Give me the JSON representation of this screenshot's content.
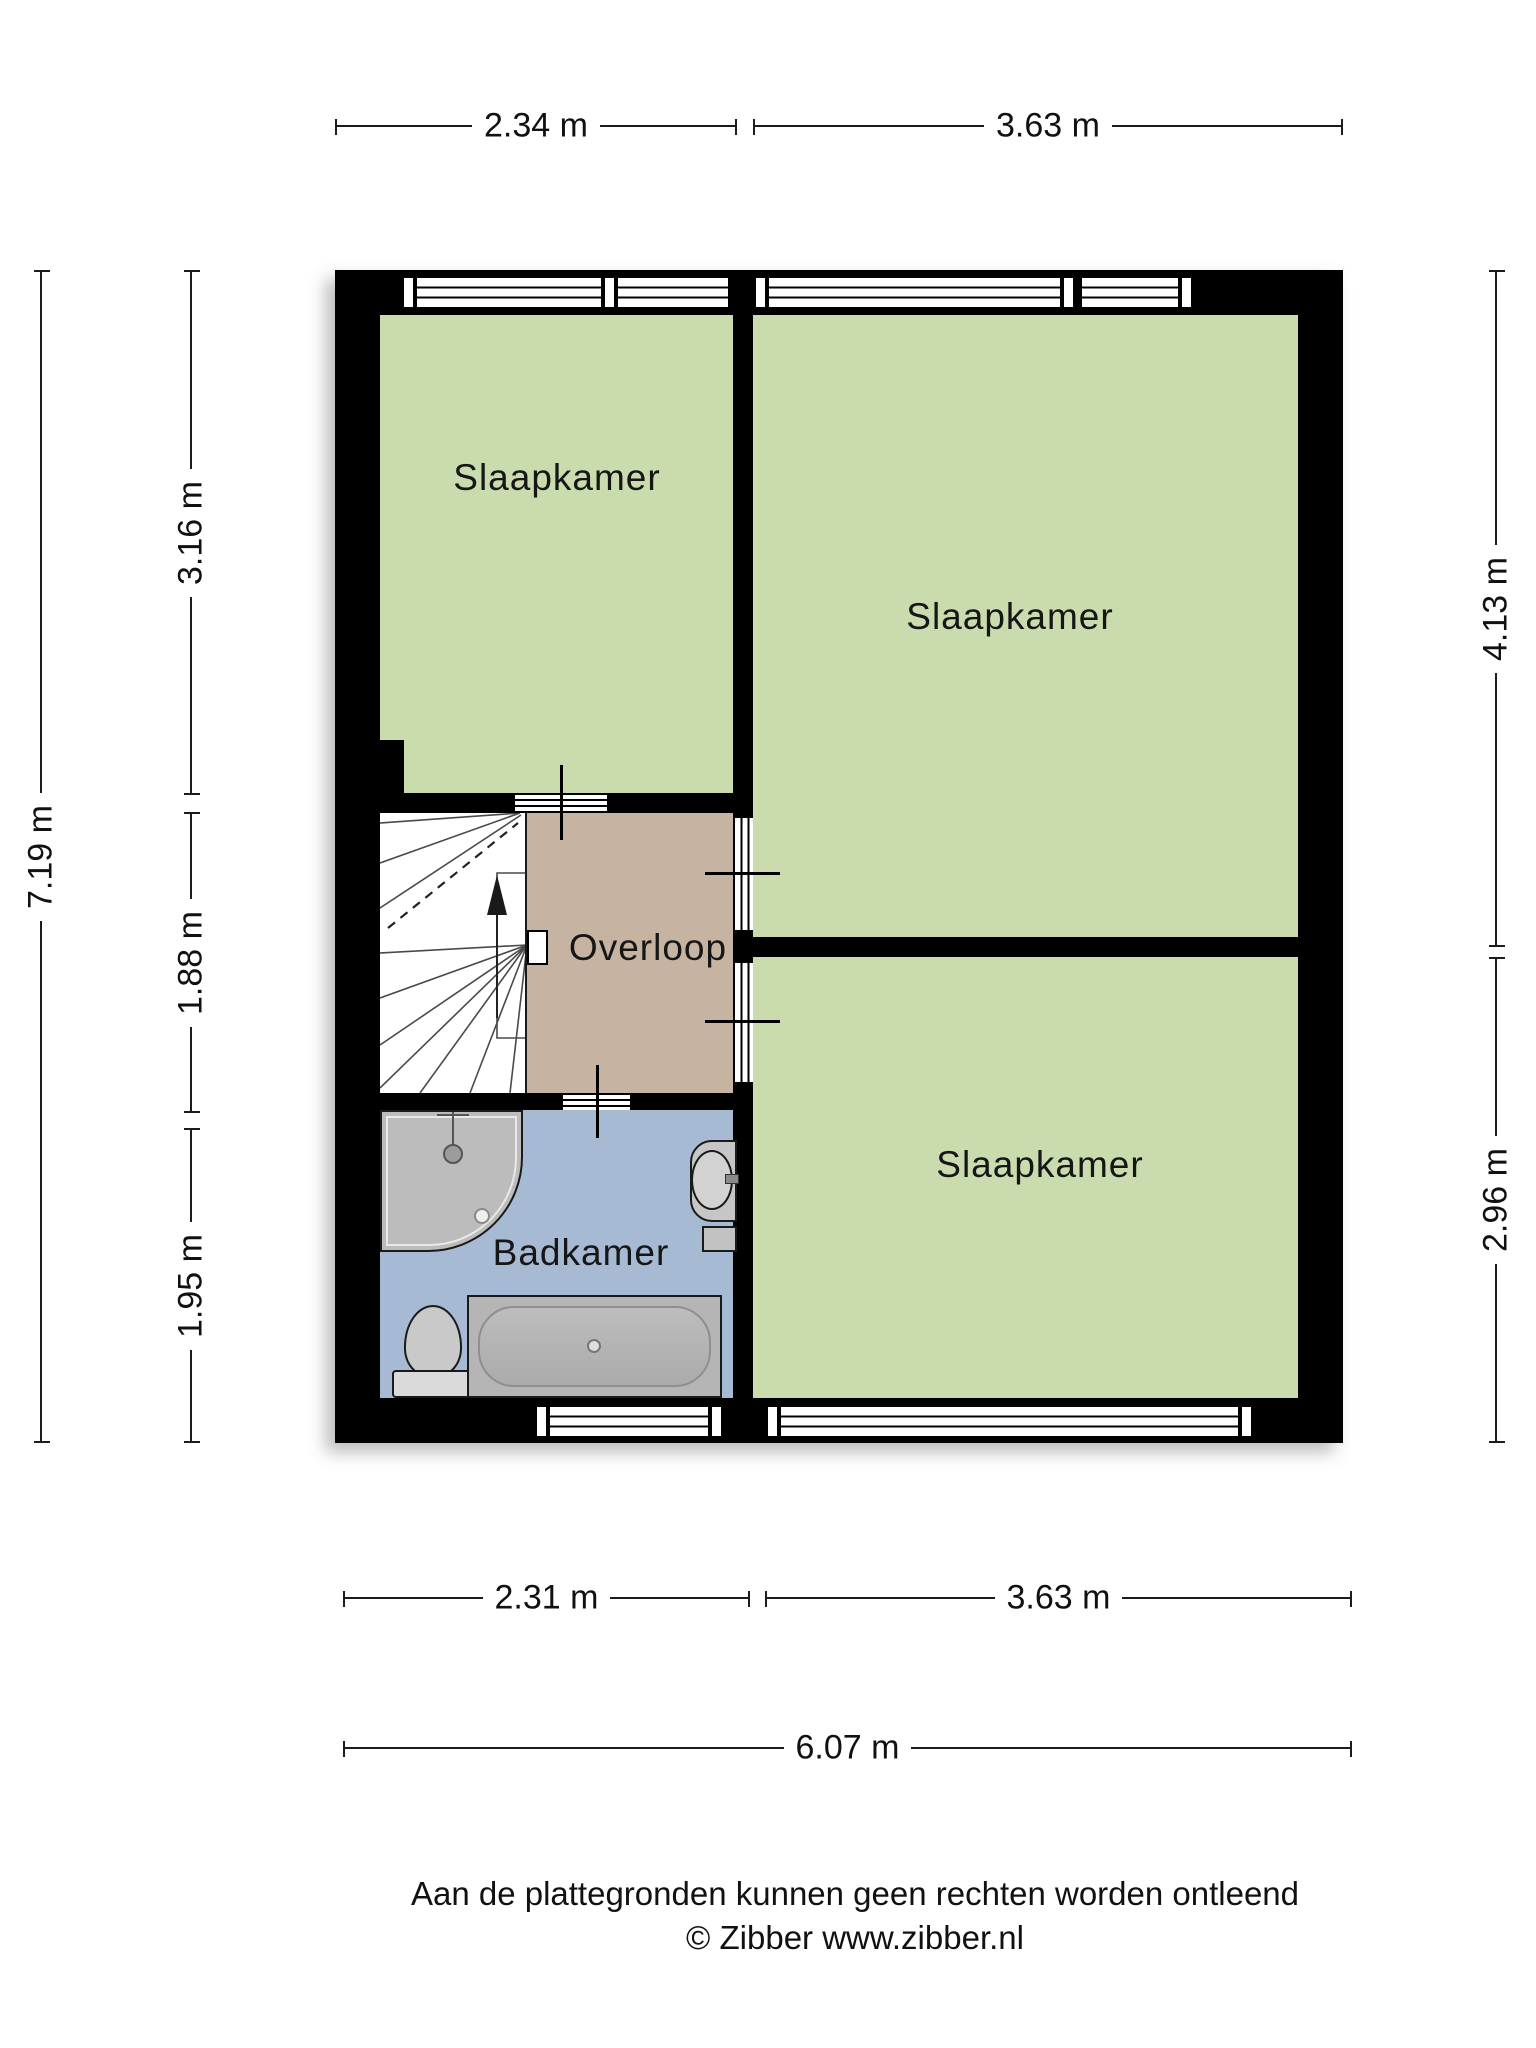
{
  "plan": {
    "rooms": [
      {
        "id": "slaapkamer-top-left",
        "label": "Slaapkamer"
      },
      {
        "id": "slaapkamer-top-right",
        "label": "Slaapkamer"
      },
      {
        "id": "slaapkamer-bottom-right",
        "label": "Slaapkamer"
      },
      {
        "id": "overloop",
        "label": "Overloop"
      },
      {
        "id": "badkamer",
        "label": "Badkamer"
      }
    ],
    "fixtures": [
      "staircase",
      "up-arrow",
      "shower",
      "sink",
      "toilet",
      "bathtub"
    ],
    "colors": {
      "bedroom_fill": "#cadcae",
      "landing_fill": "#c7b3a1",
      "bathroom_fill": "#a7bad3",
      "wall": "#000000",
      "fixture": "#bdbdbd"
    }
  },
  "dimensions": {
    "top": [
      "2.34 m",
      "3.63 m"
    ],
    "left_overall": "7.19 m",
    "left": [
      "3.16 m",
      "1.88 m",
      "1.95 m"
    ],
    "right": [
      "4.13 m",
      "2.96 m"
    ],
    "bottom": [
      "2.31 m",
      "3.63 m"
    ],
    "bottom_overall": "6.07 m"
  },
  "footer": {
    "disclaimer": "Aan de plattegronden kunnen geen rechten worden ontleend",
    "credit": "© Zibber www.zibber.nl"
  }
}
